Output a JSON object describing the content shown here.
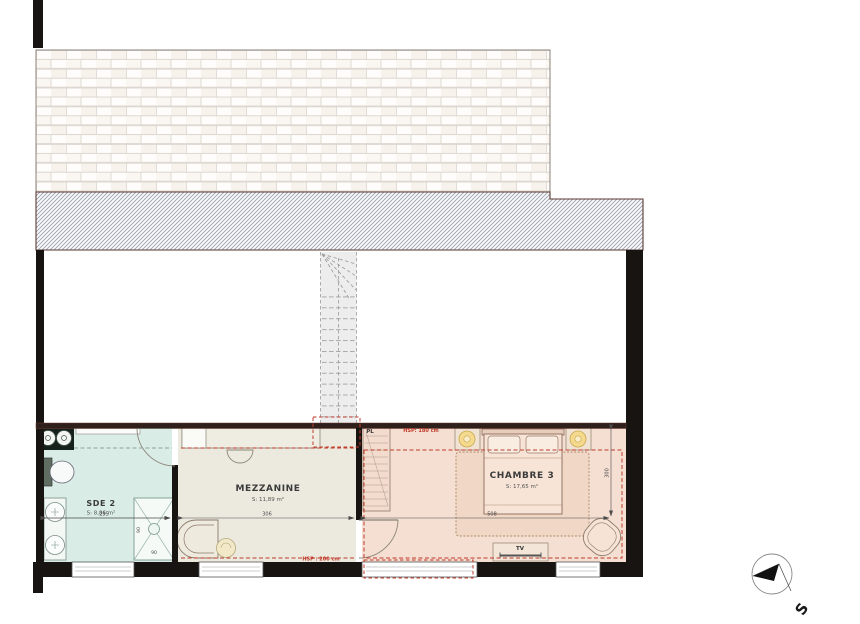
{
  "rooms": {
    "sde2": {
      "name": "SDE 2",
      "area": "S: 8,86 m²",
      "width_dim": "295"
    },
    "mezzanine": {
      "name": "MEZZANINE",
      "area": "S: 11,89 m²",
      "width_dim": "306",
      "height_note": "HSP : 200 cm"
    },
    "chambre3": {
      "name": "CHAMBRE 3",
      "area": "S: 17,65 m²",
      "width_dim": "508",
      "depth_dim": "300",
      "height_note": "HSP: 180 cm"
    }
  },
  "fixtures": {
    "closet_label": "PL",
    "tv_label": "TV",
    "shower_width_dim": "90",
    "shower_depth_dim": "90"
  },
  "compass": {
    "south_label": "S"
  },
  "colors": {
    "wall": "#181412",
    "hsp_red": "#bf3b2b",
    "sde2_fill": "#daece6",
    "mezzanine_fill": "#eceadf",
    "chambre3_fill": "#f5dfd2"
  }
}
